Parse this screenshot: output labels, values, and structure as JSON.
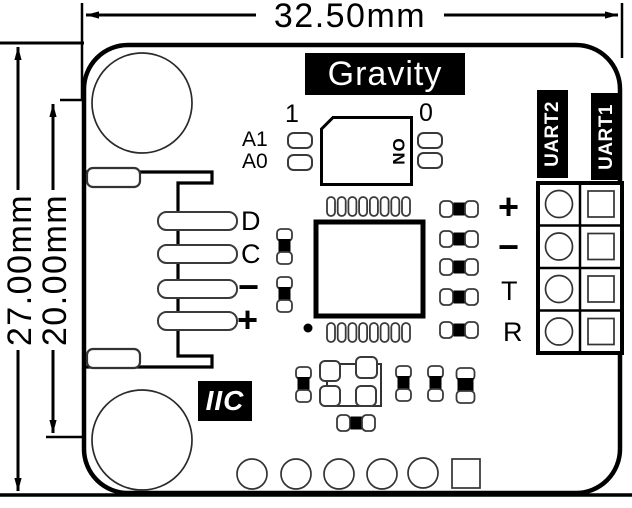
{
  "drawing": {
    "width_dim": "32.50mm",
    "outer_height_dim": "27.00mm",
    "inner_height_dim": "20.00mm"
  },
  "logo": "Gravity",
  "interface_badge": "IIC",
  "dip_switch": {
    "position_1": "1",
    "position_0": "0",
    "channels": [
      "A1",
      "A0"
    ],
    "on_marking": "ON"
  },
  "gravity_connector": {
    "pins": [
      "D",
      "C",
      "−",
      "+"
    ]
  },
  "uart_ports": {
    "port_labels": [
      "UART2",
      "UART1"
    ],
    "pin_labels": [
      "+",
      "−",
      "T",
      "R"
    ]
  },
  "colors": {
    "ink": "#000000",
    "component_stroke": "#3a3a3a",
    "badge_bg": "#000000",
    "badge_fg": "#ffffff",
    "background": "#ffffff"
  }
}
